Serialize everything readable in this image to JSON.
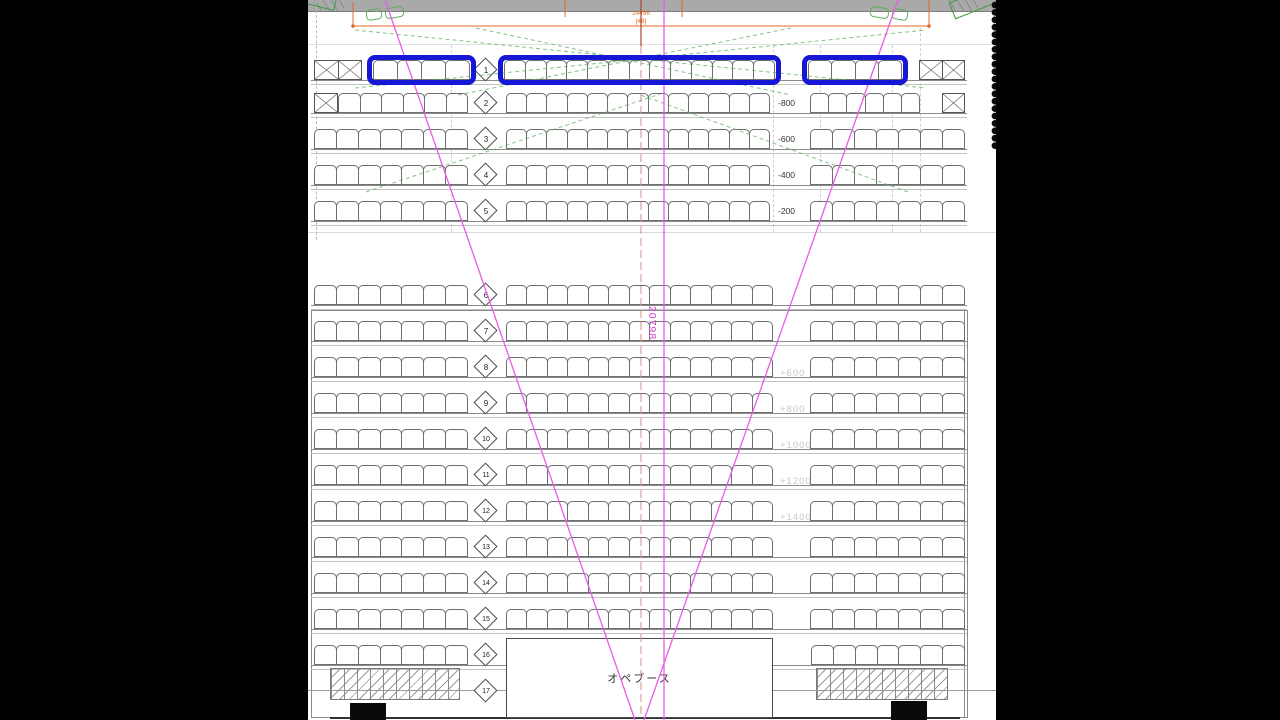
{
  "meta": {
    "drawing_type": "hall seating plan (CAD)",
    "view": "letterboxed frame"
  },
  "colors": {
    "highlight_blue": "#1616d6",
    "magenta_sightline": "#e85ce8",
    "centerline_red": "#b04331",
    "green_dashed": "#5fae5f",
    "orange_dimension": "#e06a28",
    "label_dark": "#333333",
    "label_light": "#c7c7c7"
  },
  "dimension": {
    "value": "14496",
    "sub": "[48]"
  },
  "sightline": {
    "length_label": "20798"
  },
  "booth": {
    "label": "オペブース"
  },
  "elevations_upper": [
    "-800",
    "-600",
    "-400",
    "-200"
  ],
  "elevations_lower": [
    "+600",
    "+800",
    "+1000",
    "+1200",
    "+1400"
  ],
  "rows": [
    {
      "n": "1",
      "cy": 70,
      "label": null,
      "segments": [
        {
          "t": "x",
          "x": 6,
          "w": 48,
          "c": 2
        },
        {
          "t": "s",
          "x": 65,
          "w": 97,
          "c": 4,
          "hl": true
        },
        {
          "t": "s",
          "x": 196,
          "w": 271,
          "c": 13,
          "hl": true
        },
        {
          "t": "s",
          "x": 500,
          "w": 94,
          "c": 4,
          "hl": true
        },
        {
          "t": "x",
          "x": 611,
          "w": 46,
          "c": 2
        }
      ]
    },
    {
      "n": "2",
      "cy": 103,
      "label": {
        "text": "-800",
        "tone": "dark"
      },
      "segments": [
        {
          "t": "x",
          "x": 6,
          "w": 24,
          "c": 1
        },
        {
          "t": "s",
          "x": 30,
          "w": 130,
          "c": 6
        },
        {
          "t": "s",
          "x": 198,
          "w": 264,
          "c": 13
        },
        {
          "t": "s",
          "x": 502,
          "w": 110,
          "c": 6
        },
        {
          "t": "x",
          "x": 634,
          "w": 23,
          "c": 1
        }
      ]
    },
    {
      "n": "3",
      "cy": 139,
      "label": {
        "text": "-600",
        "tone": "dark"
      },
      "segments": [
        {
          "t": "s",
          "x": 6,
          "w": 154,
          "c": 7
        },
        {
          "t": "s",
          "x": 198,
          "w": 264,
          "c": 13
        },
        {
          "t": "s",
          "x": 502,
          "w": 155,
          "c": 7
        }
      ]
    },
    {
      "n": "4",
      "cy": 175,
      "label": {
        "text": "-400",
        "tone": "dark"
      },
      "segments": [
        {
          "t": "s",
          "x": 6,
          "w": 154,
          "c": 7
        },
        {
          "t": "s",
          "x": 198,
          "w": 264,
          "c": 13
        },
        {
          "t": "s",
          "x": 502,
          "w": 155,
          "c": 7
        }
      ]
    },
    {
      "n": "5",
      "cy": 211,
      "label": {
        "text": "-200",
        "tone": "dark"
      },
      "segments": [
        {
          "t": "s",
          "x": 6,
          "w": 154,
          "c": 7
        },
        {
          "t": "s",
          "x": 198,
          "w": 264,
          "c": 13
        },
        {
          "t": "s",
          "x": 502,
          "w": 155,
          "c": 7
        }
      ]
    },
    {
      "n": "6",
      "cy": 295,
      "label": null,
      "segments": [
        {
          "t": "s",
          "x": 6,
          "w": 154,
          "c": 7
        },
        {
          "t": "s",
          "x": 198,
          "w": 267,
          "c": 13
        },
        {
          "t": "s",
          "x": 502,
          "w": 155,
          "c": 7
        }
      ]
    },
    {
      "n": "7",
      "cy": 331,
      "label": null,
      "segments": [
        {
          "t": "s",
          "x": 6,
          "w": 154,
          "c": 7
        },
        {
          "t": "s",
          "x": 198,
          "w": 267,
          "c": 13
        },
        {
          "t": "s",
          "x": 502,
          "w": 155,
          "c": 7
        }
      ]
    },
    {
      "n": "8",
      "cy": 367,
      "label": {
        "text": "+600",
        "tone": "light"
      },
      "segments": [
        {
          "t": "s",
          "x": 6,
          "w": 154,
          "c": 7
        },
        {
          "t": "s",
          "x": 198,
          "w": 267,
          "c": 13
        },
        {
          "t": "s",
          "x": 502,
          "w": 155,
          "c": 7
        }
      ]
    },
    {
      "n": "9",
      "cy": 403,
      "label": {
        "text": "+800",
        "tone": "light"
      },
      "segments": [
        {
          "t": "s",
          "x": 6,
          "w": 154,
          "c": 7
        },
        {
          "t": "s",
          "x": 198,
          "w": 267,
          "c": 13
        },
        {
          "t": "s",
          "x": 502,
          "w": 155,
          "c": 7
        }
      ]
    },
    {
      "n": "10",
      "cy": 439,
      "label": {
        "text": "+1000",
        "tone": "light"
      },
      "segments": [
        {
          "t": "s",
          "x": 6,
          "w": 154,
          "c": 7
        },
        {
          "t": "s",
          "x": 198,
          "w": 267,
          "c": 13
        },
        {
          "t": "s",
          "x": 502,
          "w": 155,
          "c": 7
        }
      ]
    },
    {
      "n": "11",
      "cy": 475,
      "label": {
        "text": "+1200",
        "tone": "light"
      },
      "segments": [
        {
          "t": "s",
          "x": 6,
          "w": 154,
          "c": 7
        },
        {
          "t": "s",
          "x": 198,
          "w": 267,
          "c": 13
        },
        {
          "t": "s",
          "x": 502,
          "w": 155,
          "c": 7
        }
      ]
    },
    {
      "n": "12",
      "cy": 511,
      "label": {
        "text": "+1400",
        "tone": "light"
      },
      "segments": [
        {
          "t": "s",
          "x": 6,
          "w": 154,
          "c": 7
        },
        {
          "t": "s",
          "x": 198,
          "w": 267,
          "c": 13
        },
        {
          "t": "s",
          "x": 502,
          "w": 155,
          "c": 7
        }
      ]
    },
    {
      "n": "13",
      "cy": 547,
      "label": null,
      "segments": [
        {
          "t": "s",
          "x": 6,
          "w": 154,
          "c": 7
        },
        {
          "t": "s",
          "x": 198,
          "w": 267,
          "c": 13
        },
        {
          "t": "s",
          "x": 502,
          "w": 155,
          "c": 7
        }
      ]
    },
    {
      "n": "14",
      "cy": 583,
      "label": null,
      "segments": [
        {
          "t": "s",
          "x": 6,
          "w": 154,
          "c": 7
        },
        {
          "t": "s",
          "x": 198,
          "w": 267,
          "c": 13
        },
        {
          "t": "s",
          "x": 502,
          "w": 155,
          "c": 7
        }
      ]
    },
    {
      "n": "15",
      "cy": 619,
      "label": null,
      "segments": [
        {
          "t": "s",
          "x": 6,
          "w": 154,
          "c": 7
        },
        {
          "t": "s",
          "x": 198,
          "w": 267,
          "c": 13
        },
        {
          "t": "s",
          "x": 502,
          "w": 155,
          "c": 7
        }
      ]
    },
    {
      "n": "16",
      "cy": 655,
      "label": null,
      "segments": [
        {
          "t": "s",
          "x": 6,
          "w": 154,
          "c": 7
        },
        {
          "t": "s",
          "x": 503,
          "w": 154,
          "c": 7
        }
      ]
    },
    {
      "n": "17",
      "cy": 691,
      "label": null,
      "segments": []
    }
  ]
}
